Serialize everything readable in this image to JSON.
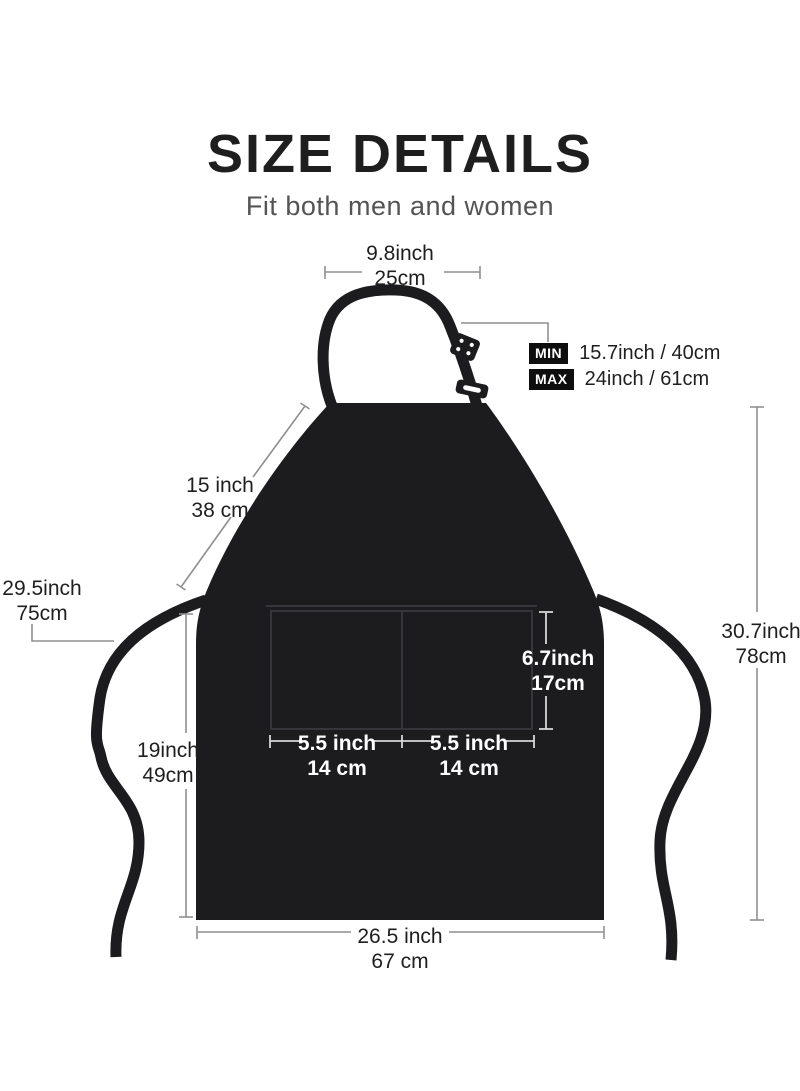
{
  "header": {
    "title": "SIZE DETAILS",
    "subtitle": "Fit both men and women"
  },
  "dimensions": {
    "neck_width": {
      "inch": "9.8inch",
      "cm": "25cm"
    },
    "neck_strap": {
      "min_label": "MIN",
      "min_value": "15.7inch / 40cm",
      "max_label": "MAX",
      "max_value": "24inch / 61cm"
    },
    "bib_diagonal": {
      "inch": "15 inch",
      "cm": "38 cm"
    },
    "waist_tie": {
      "inch": "29.5inch",
      "cm": "75cm"
    },
    "total_height": {
      "inch": "30.7inch",
      "cm": "78cm"
    },
    "skirt_height": {
      "inch": "19inch",
      "cm": "49cm"
    },
    "pocket_height": {
      "inch": "6.7inch",
      "cm": "17cm"
    },
    "pocket_left": {
      "inch": "5.5 inch",
      "cm": "14 cm"
    },
    "pocket_right": {
      "inch": "5.5 inch",
      "cm": "14 cm"
    },
    "bottom_width": {
      "inch": "26.5 inch",
      "cm": "67 cm"
    }
  },
  "colors": {
    "background": "#ffffff",
    "apron_fabric": "#1c1c1f",
    "pocket_stitch": "#35353b",
    "measure_line": "#8f8f8f",
    "measure_line_on_dark": "#d6d6d6",
    "text_dark": "#1f1f1f",
    "subtitle_gray": "#545454",
    "badge_bg": "#0e0e0e",
    "badge_text": "#ffffff"
  }
}
